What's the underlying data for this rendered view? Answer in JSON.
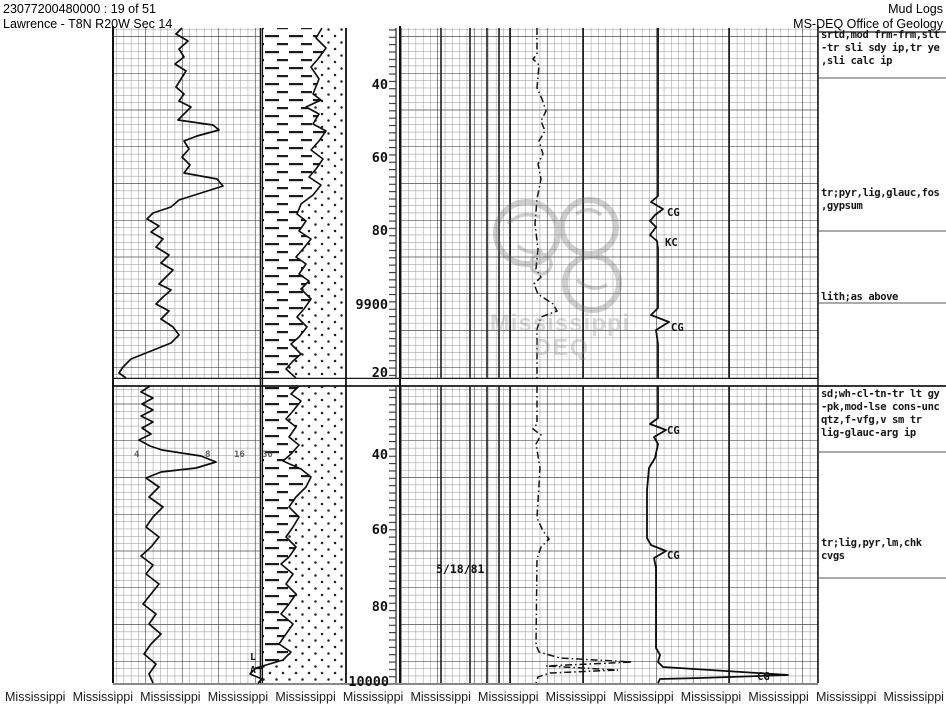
{
  "header": {
    "doc_id": "23077200480000 : 19 of 51",
    "location": "Lawrence - T8N R20W Sec 14",
    "title": "Mud Logs",
    "agency": "MS-DEQ Office of Geology"
  },
  "depth": {
    "u1": "40",
    "u2": "60",
    "u3": "80",
    "u4": "9900",
    "u5": "20",
    "l1": "40",
    "l2": "60",
    "l3": "80",
    "l4": "10000"
  },
  "scale_numbers": {
    "s1": "4",
    "s2": "8",
    "s3": "16",
    "s4": "30"
  },
  "gas_labels": {
    "g1": "CG",
    "g2": "KC",
    "g3": "CG",
    "g4": "CG",
    "g5": "CG",
    "g6": "CG"
  },
  "date_note": "5/18/81",
  "litho_marks": {
    "m1": "L",
    "m2": "A"
  },
  "annotations": {
    "a1": "srtd,mod frm-frm,slt\n-tr sli sdy ip,tr ye\n,sli calc ip",
    "a2": "tr;pyr,lig,glauc,fos\n,gypsum",
    "a3": "lith;as above",
    "a4": "sd;wh-cl-tn-tr lt gy\n-pk,mod-lse cons-unc\nqtz,f-vfg,v sm tr\nlig-glauc-arg ip",
    "a5": "tr;lig,pyr,lm,chk\ncvgs"
  },
  "watermark": {
    "line1": "Mississippi",
    "line2": "DEQ"
  },
  "footer": {
    "items": [
      "Mississippi",
      "Mississippi",
      "Mississippi",
      "Mississippi",
      "Mississippi",
      "Mississippi",
      "Mississippi",
      "Mississippi",
      "Mississippi",
      "Mississippi",
      "Mississippi",
      "Mississippi",
      "Mississippi",
      "Mississippi"
    ]
  },
  "colors": {
    "ink": "#111111",
    "watermark_gray": "#8c8c8c"
  }
}
